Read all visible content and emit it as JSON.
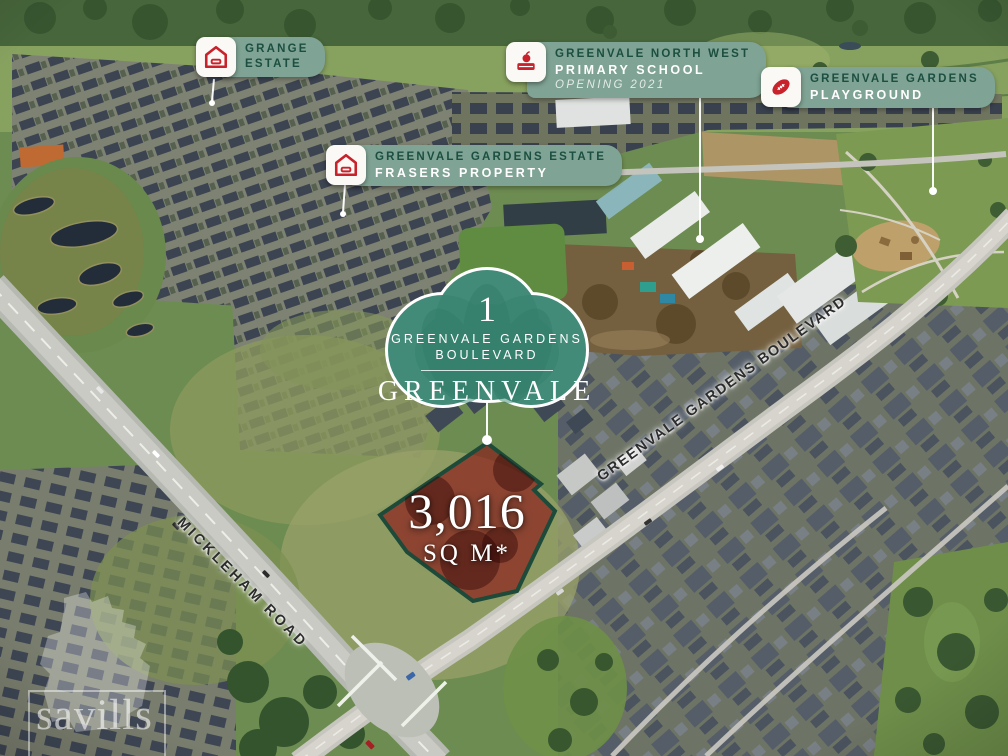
{
  "callouts": [
    {
      "id": "grange-estate",
      "icon": "house-icon",
      "lines": [
        "GRANGE",
        "ESTATE"
      ]
    },
    {
      "id": "primary-school",
      "icon": "school-book-apple-icon",
      "lines": [
        "GREENVALE NORTH WEST",
        "PRIMARY SCHOOL",
        "OPENING 2021"
      ]
    },
    {
      "id": "playground",
      "icon": "football-icon",
      "lines": [
        "GREENVALE GARDENS",
        "PLAYGROUND"
      ]
    },
    {
      "id": "frasers-estate",
      "icon": "house-icon",
      "lines": [
        "GREENVALE GARDENS ESTATE",
        "FRASERS PROPERTY"
      ]
    }
  ],
  "badge": {
    "number": "1",
    "street": "GREENVALE GARDENS",
    "street2": "BOULEVARD",
    "suburb": "GREENVALE"
  },
  "lot": {
    "area": "3,016",
    "unit": "SQ M*"
  },
  "roads": [
    {
      "name": "MICKLEHAM ROAD"
    },
    {
      "name": "GREENVALE GARDENS BOULEVARD"
    }
  ],
  "watermark": {
    "brand": "savills"
  },
  "colors": {
    "plaque_green": "#7FA394",
    "plaque_text_dark": "#1C4F40",
    "icon_red": "#C8232C",
    "badge_green": "#3A8673",
    "lot_fill": "#8C0C13",
    "lot_border": "#1D4A39"
  }
}
